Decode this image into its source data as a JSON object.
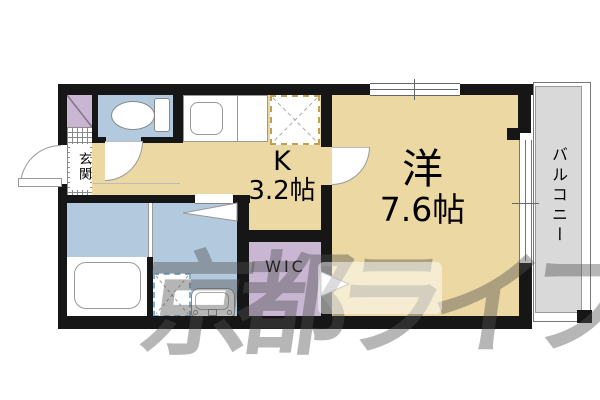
{
  "title": "1K apartment floor plan",
  "labels": {
    "entrance": "玄関",
    "kitchen_letter": "K",
    "kitchen_size": "3.2帖",
    "main_room": "洋",
    "main_room_size": "7.6帖",
    "wic": "WIC",
    "balcony": "バルコニー"
  },
  "watermark": "京都ライフ",
  "colors": {
    "floor_beige": "#ecd8a3",
    "wet_area_blue": "#b3cade",
    "closet_purple": "#c9b6d2",
    "balcony_gray": "#d9d9d9",
    "wall_black": "#161616",
    "tile_line_gray": "#8a8a8a",
    "watermark_gray": "rgba(80,80,80,0.42)"
  },
  "icons": [
    "toilet-icon",
    "kitchen-sink-icon",
    "refrigerator-space-icon",
    "bathtub-icon",
    "washing-machine-space-icon",
    "washbasin-icon",
    "entrance-door-arc-icon",
    "toilet-door-arc-icon",
    "kitchen-door-arc-icon",
    "door-direction-triangle-icon",
    "wic-entry-arrow-icon",
    "window-icon",
    "balcony-sliding-window-icon"
  ]
}
